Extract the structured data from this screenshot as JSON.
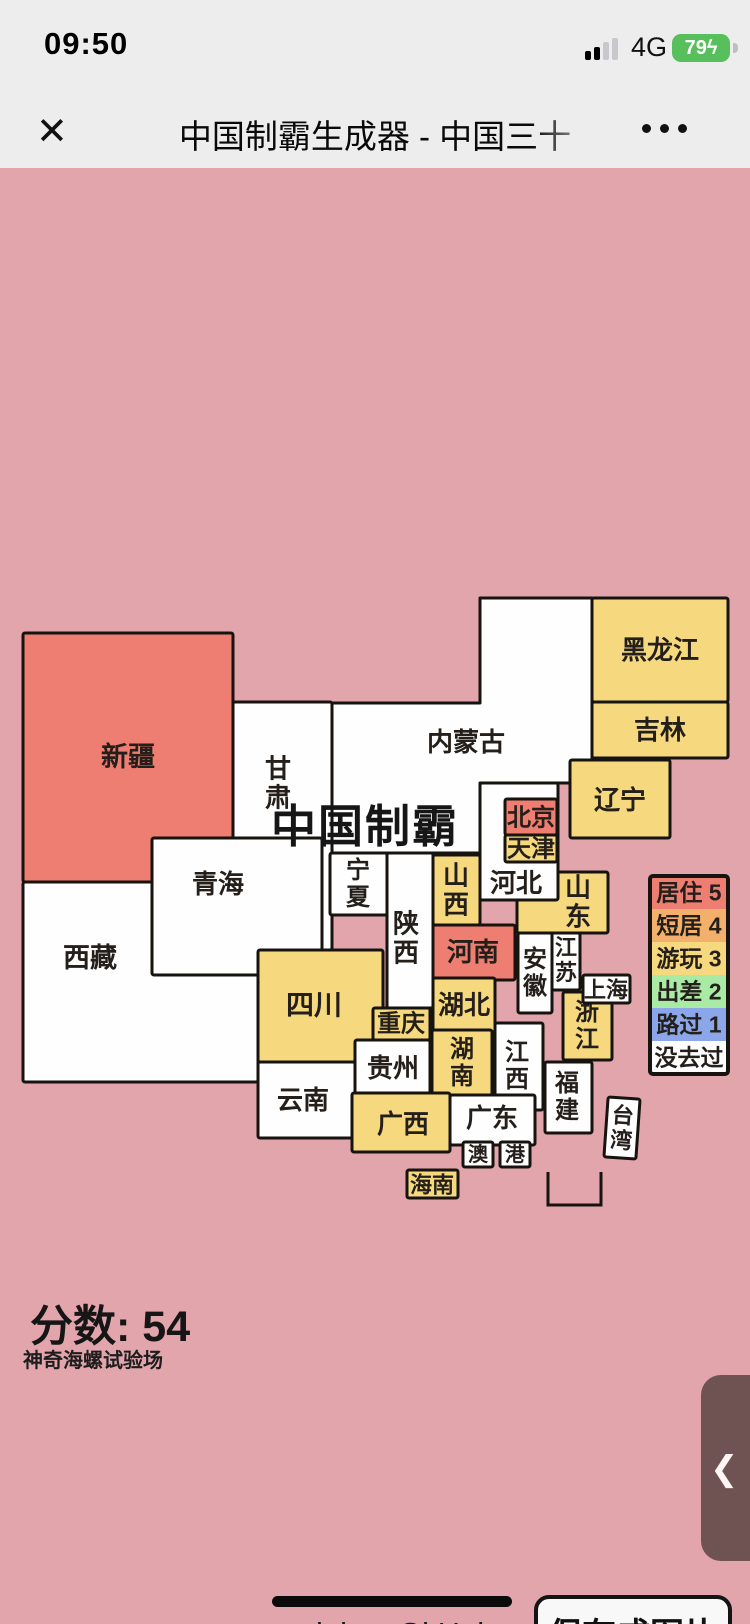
{
  "status_bar": {
    "time": "09:50",
    "network": "4G",
    "battery": "79",
    "bolt": "ϟ",
    "signal_bars_filled": 2,
    "signal_bars_total": 4
  },
  "nav": {
    "title": "中国制霸生成器 - 中国三十",
    "close_icon": "✕"
  },
  "map": {
    "title": "中国制霸",
    "score_label": "分数: ",
    "score": "54",
    "subtitle": "神奇海螺试验场",
    "colors": {
      "bg": "#e2a5ac",
      "stroke": "#17130e",
      "label": "#241f1a",
      "levels": [
        "#fefefe",
        "#8ca7e9",
        "#a9eba4",
        "#f6d97e",
        "#f3b06c",
        "#ee7e71"
      ]
    },
    "legend": {
      "x": 650,
      "y": 876,
      "row_w": 78,
      "row_h": 33,
      "rows": [
        {
          "id": "lv5",
          "label": "居住 5",
          "level": 5
        },
        {
          "id": "lv4",
          "label": "短居 4",
          "level": 4
        },
        {
          "id": "lv3",
          "label": "游玩 3",
          "level": 3
        },
        {
          "id": "lv2",
          "label": "出差 2",
          "level": 2
        },
        {
          "id": "lv1",
          "label": "路过 1",
          "level": 1
        },
        {
          "id": "lv0",
          "label": "没去过",
          "level": 0
        }
      ]
    },
    "provinces": [
      {
        "id": "xinjiang",
        "name": "新疆",
        "x": 23,
        "y": 633,
        "w": 210,
        "h": 249,
        "level": 5,
        "lx": 128,
        "ly": 757,
        "orient": "h",
        "fs": 27
      },
      {
        "id": "xizang",
        "name": "西藏",
        "x": 23,
        "y": 882,
        "w": 235,
        "h": 200,
        "level": 0,
        "lx": 90,
        "ly": 958,
        "orient": "h",
        "fs": 27
      },
      {
        "id": "gansu",
        "name": "甘肃",
        "x": 233,
        "y": 702,
        "w": 99,
        "h": 248,
        "level": 0,
        "lx": 278,
        "ly": 783,
        "orient": "v",
        "fs": 26
      },
      {
        "id": "qinghai",
        "name": "青海",
        "x": 152,
        "y": 838,
        "w": 170,
        "h": 137,
        "level": 0,
        "lx": 218,
        "ly": 884,
        "orient": "h",
        "fs": 26
      },
      {
        "id": "neimenggu",
        "name": "内蒙古",
        "points": "332,703 480,703 480,598 592,598 592,783 480,783 480,853 332,853",
        "level": 0,
        "lx": 466,
        "ly": 742,
        "orient": "h",
        "fs": 26
      },
      {
        "id": "heilongjiang",
        "name": "黑龙江",
        "x": 592,
        "y": 598,
        "w": 136,
        "h": 104,
        "level": 3,
        "lx": 660,
        "ly": 650,
        "orient": "h",
        "fs": 26
      },
      {
        "id": "jilin",
        "name": "吉林",
        "x": 592,
        "y": 702,
        "w": 136,
        "h": 56,
        "level": 3,
        "lx": 660,
        "ly": 730,
        "orient": "h",
        "fs": 26
      },
      {
        "id": "liaoning",
        "name": "辽宁",
        "x": 570,
        "y": 760,
        "w": 100,
        "h": 78,
        "level": 3,
        "lx": 620,
        "ly": 800,
        "orient": "h",
        "fs": 26
      },
      {
        "id": "ningxia",
        "name": "宁夏",
        "x": 330,
        "y": 853,
        "w": 57,
        "h": 62,
        "level": 0,
        "lx": 358,
        "ly": 884,
        "orient": "v",
        "fs": 24
      },
      {
        "id": "shaanxi",
        "name": "陕西",
        "x": 387,
        "y": 853,
        "w": 46,
        "h": 155,
        "level": 0,
        "lx": 406,
        "ly": 938,
        "orient": "v",
        "fs": 26
      },
      {
        "id": "shanxi",
        "name": "山西",
        "x": 433,
        "y": 855,
        "w": 47,
        "h": 70,
        "level": 3,
        "lx": 456,
        "ly": 890,
        "orient": "v",
        "fs": 26
      },
      {
        "id": "shandong",
        "name": "山东",
        "x": 517,
        "y": 872,
        "w": 91,
        "h": 61,
        "level": 3,
        "lx": 578,
        "ly": 902,
        "orient": "v",
        "fs": 26
      },
      {
        "id": "hebei",
        "name": "河北",
        "x": 480,
        "y": 783,
        "w": 78,
        "h": 117,
        "level": 0,
        "lx": 516,
        "ly": 883,
        "orient": "h",
        "fs": 26
      },
      {
        "id": "beijing",
        "name": "北京",
        "x": 505,
        "y": 799,
        "w": 52,
        "h": 36,
        "level": 5,
        "lx": 531,
        "ly": 818,
        "orient": "h",
        "fs": 24
      },
      {
        "id": "tianjin",
        "name": "天津",
        "x": 505,
        "y": 835,
        "w": 52,
        "h": 27,
        "level": 3,
        "lx": 531,
        "ly": 849,
        "orient": "h",
        "fs": 24
      },
      {
        "id": "henan",
        "name": "河南",
        "x": 433,
        "y": 925,
        "w": 82,
        "h": 55,
        "level": 5,
        "lx": 473,
        "ly": 952,
        "orient": "h",
        "fs": 26
      },
      {
        "id": "jiangsu",
        "name": "江苏",
        "x": 552,
        "y": 933,
        "w": 28,
        "h": 57,
        "level": 0,
        "lx": 566,
        "ly": 960,
        "orient": "v",
        "fs": 22
      },
      {
        "id": "anhui",
        "name": "安徽",
        "x": 518,
        "y": 933,
        "w": 34,
        "h": 80,
        "level": 0,
        "lx": 535,
        "ly": 973,
        "orient": "v",
        "fs": 24
      },
      {
        "id": "sichuan",
        "name": "四川",
        "x": 258,
        "y": 950,
        "w": 125,
        "h": 112,
        "level": 3,
        "lx": 314,
        "ly": 1005,
        "orient": "h",
        "fs": 28
      },
      {
        "id": "chongqing",
        "name": "重庆",
        "x": 373,
        "y": 1008,
        "w": 57,
        "h": 32,
        "level": 3,
        "lx": 401,
        "ly": 1024,
        "orient": "h",
        "fs": 24
      },
      {
        "id": "hubei",
        "name": "湖北",
        "x": 433,
        "y": 978,
        "w": 62,
        "h": 54,
        "level": 3,
        "lx": 464,
        "ly": 1005,
        "orient": "h",
        "fs": 26
      },
      {
        "id": "zhejiang",
        "name": "浙江",
        "x": 563,
        "y": 992,
        "w": 49,
        "h": 68,
        "level": 3,
        "lx": 587,
        "ly": 1026,
        "orient": "v",
        "fs": 24
      },
      {
        "id": "shanghai",
        "name": "上海",
        "x": 583,
        "y": 975,
        "w": 47,
        "h": 28,
        "level": 0,
        "lx": 606,
        "ly": 990,
        "orient": "h",
        "fs": 22
      },
      {
        "id": "hunan",
        "name": "湖南",
        "x": 432,
        "y": 1030,
        "w": 60,
        "h": 67,
        "level": 3,
        "lx": 462,
        "ly": 1063,
        "orient": "v",
        "fs": 24
      },
      {
        "id": "guizhou",
        "name": "贵州",
        "x": 355,
        "y": 1040,
        "w": 75,
        "h": 57,
        "level": 0,
        "lx": 393,
        "ly": 1068,
        "orient": "h",
        "fs": 26
      },
      {
        "id": "yunnan",
        "name": "云南",
        "x": 258,
        "y": 1062,
        "w": 97,
        "h": 76,
        "level": 0,
        "lx": 303,
        "ly": 1100,
        "orient": "h",
        "fs": 26
      },
      {
        "id": "jiangxi",
        "name": "江西",
        "x": 495,
        "y": 1023,
        "w": 48,
        "h": 87,
        "level": 0,
        "lx": 517,
        "ly": 1066,
        "orient": "v",
        "fs": 24
      },
      {
        "id": "fujian",
        "name": "福建",
        "x": 545,
        "y": 1062,
        "w": 47,
        "h": 71,
        "level": 0,
        "lx": 567,
        "ly": 1097,
        "orient": "v",
        "fs": 24
      },
      {
        "id": "guangxi",
        "name": "广西",
        "x": 352,
        "y": 1093,
        "w": 98,
        "h": 59,
        "level": 3,
        "lx": 403,
        "ly": 1124,
        "orient": "h",
        "fs": 26
      },
      {
        "id": "guangdong",
        "name": "广东",
        "x": 450,
        "y": 1095,
        "w": 85,
        "h": 50,
        "level": 0,
        "lx": 492,
        "ly": 1118,
        "orient": "h",
        "fs": 26
      },
      {
        "id": "aomen",
        "name": "澳",
        "x": 463,
        "y": 1142,
        "w": 30,
        "h": 25,
        "level": 0,
        "lx": 478,
        "ly": 1155,
        "orient": "h",
        "fs": 20
      },
      {
        "id": "xianggang",
        "name": "港",
        "x": 500,
        "y": 1142,
        "w": 30,
        "h": 25,
        "level": 0,
        "lx": 515,
        "ly": 1155,
        "orient": "h",
        "fs": 20
      },
      {
        "id": "hainan",
        "name": "海南",
        "x": 407,
        "y": 1170,
        "w": 51,
        "h": 28,
        "level": 3,
        "lx": 432,
        "ly": 1185,
        "orient": "h",
        "fs": 22
      },
      {
        "id": "taiwan",
        "name": "台湾",
        "x": 606,
        "y": 1098,
        "w": 32,
        "h": 60,
        "level": 0,
        "lx": 622,
        "ly": 1128,
        "orient": "v",
        "fs": 22,
        "rotate": 4
      }
    ],
    "sea_box": {
      "x": 548,
      "y": 1172,
      "w": 53,
      "h": 33
    }
  },
  "footer": {
    "links": [
      {
        "id": "lab",
        "label": "lab"
      },
      {
        "id": "github",
        "label": "GitHub"
      }
    ],
    "save_button": "保存成图片"
  },
  "handle": {
    "chevron": "❮"
  }
}
